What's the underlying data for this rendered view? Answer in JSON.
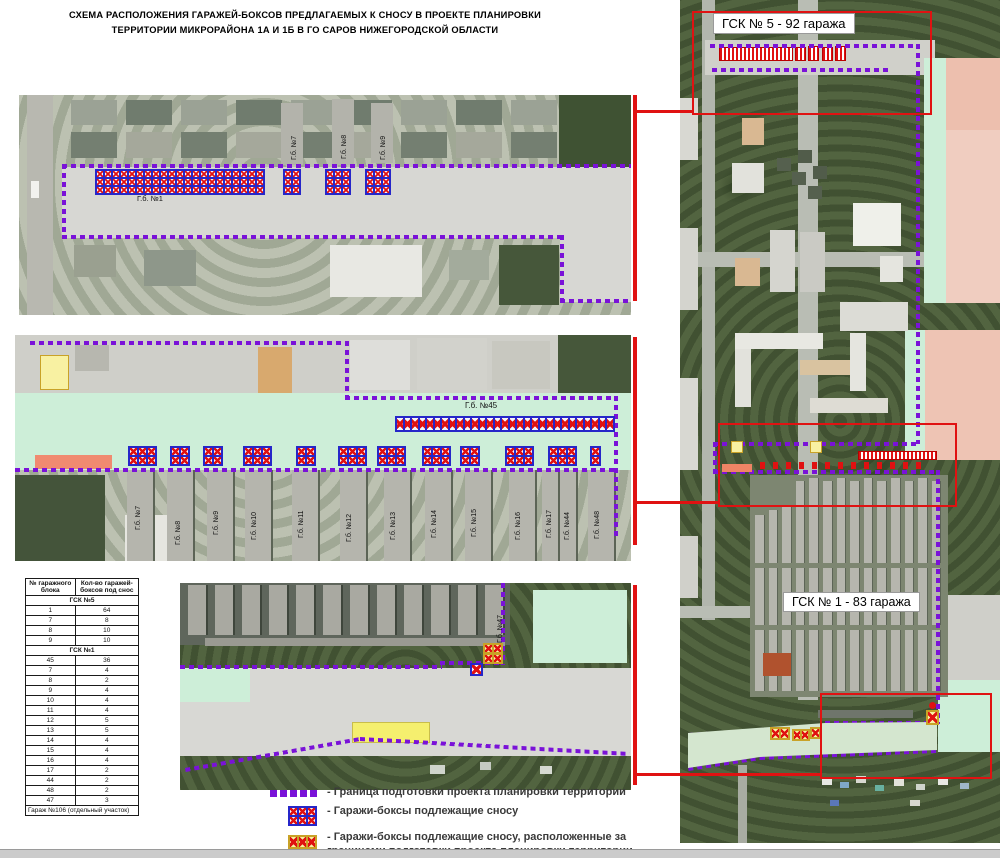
{
  "title": {
    "line1": "СХЕМА РАСПОЛОЖЕНИЯ ГАРАЖЕЙ-БОКСОВ ПРЕДЛАГАЕМЫХ К СНОСУ В ПРОЕКТЕ ПЛАНИРОВКИ",
    "line2": "ТЕРРИТОРИИ МИКРОРАЙОНА 1А И 1Б В ГО САРОВ НИЖЕГОРОДСКОЙ ОБЛАСТИ"
  },
  "callouts": {
    "gsk5": "ГСК № 5 - 92 гаража",
    "gsk1": "ГСК № 1 - 83 гаража"
  },
  "panel_top": {
    "block_main": "Г.б. №1",
    "vertical_blocks": [
      "Г.б. №7",
      "Г.б. №8",
      "Г.б. №9"
    ]
  },
  "panel_middle": {
    "row_block": "Г.б. №45",
    "vertical_blocks": [
      "Г.б. №7",
      "Г.б. №8",
      "Г.б. №9",
      "Г.б. №10",
      "Г.б. №11",
      "Г.б. №12",
      "Г.б. №13",
      "Г.б. №14",
      "Г.б. №15",
      "Г.б. №16",
      "Г.б. №17",
      "Г.б. №44",
      "Г.б. №48"
    ]
  },
  "panel_bottom": {
    "vertical_block": "Г.б. №47"
  },
  "table": {
    "headers": [
      "№ гаражного блока",
      "Кол-во гаражей-боксов под снос"
    ],
    "sections": [
      {
        "title": "ГСК №5",
        "rows": [
          [
            "1",
            "64"
          ],
          [
            "7",
            "8"
          ],
          [
            "8",
            "10"
          ],
          [
            "9",
            "10"
          ]
        ]
      },
      {
        "title": "ГСК №1",
        "rows": [
          [
            "45",
            "36"
          ],
          [
            "7",
            "4"
          ],
          [
            "8",
            "2"
          ],
          [
            "9",
            "4"
          ],
          [
            "10",
            "4"
          ],
          [
            "11",
            "4"
          ],
          [
            "12",
            "5"
          ],
          [
            "13",
            "5"
          ],
          [
            "14",
            "4"
          ],
          [
            "15",
            "4"
          ],
          [
            "16",
            "4"
          ],
          [
            "17",
            "2"
          ],
          [
            "44",
            "2"
          ],
          [
            "48",
            "2"
          ],
          [
            "47",
            "3"
          ]
        ]
      }
    ],
    "footer": "Гараж №106 (отдельный участок)"
  },
  "legend": {
    "items": [
      {
        "swatch": "boundary",
        "text": "- Граница подготовки проекта планировки территории"
      },
      {
        "swatch": "demolish",
        "text": "- Гаражи-боксы подлежащие сносу"
      },
      {
        "swatch": "demolish-outside",
        "text": "- Гаражи-боксы подлежащие сносу, расположенные за границами подготовки проекта планировки территории"
      }
    ]
  },
  "colors": {
    "boundary": "#7a12d8",
    "garage_border": "#2626c9",
    "garage_x": "#e01111",
    "outside_fill": "#f8f1a2",
    "outside_border": "#c9a227",
    "callout_red": "#e01212",
    "zone_green": "#cdeed8",
    "zone_salmon": "#efc5b5"
  }
}
